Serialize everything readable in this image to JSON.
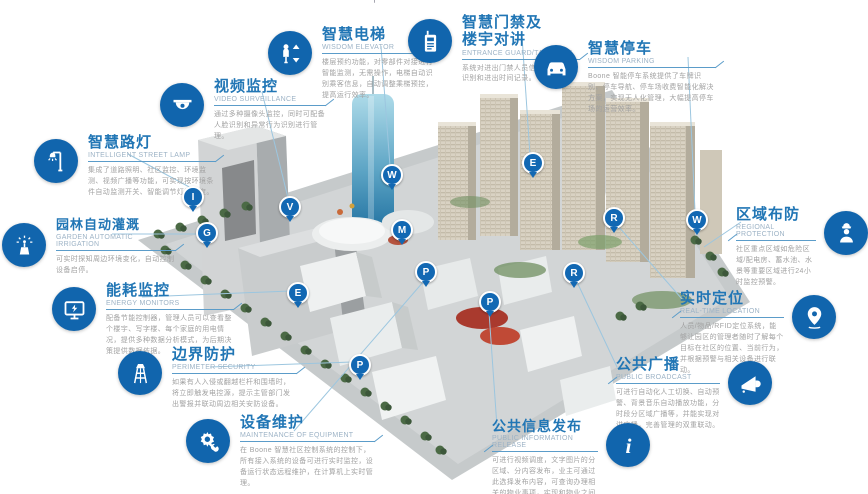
{
  "colors": {
    "icon_circle_blue": "#1165ad",
    "title_blue": "#2176b5",
    "subtitle_gray": "#9db3c6",
    "desc_gray": "#a2a2a2",
    "connector_blue": "#9cc6df",
    "marker_blue": "#1268b3",
    "red_accent_roof": "#a93a2e"
  },
  "top_edge_fragment": "丶丶丨丶丶丶",
  "callouts": [
    {
      "id": "wisdom-elevator",
      "title": "智慧电梯",
      "subtitle": "WISDOM ELEVATOR",
      "icon": "elevator-icon",
      "desc": "楼层预约功能，对零部件对接进行智能监测，无需操作，电梯自动识别乘客信息，自动调整乘梯预控，提高运行效率。"
    },
    {
      "id": "entrance-guard",
      "title": "智慧门禁及\n楼宇对讲",
      "subtitle": "ENTRANCE GUARD/TALKBACK",
      "icon": "intercom-icon",
      "desc": "系统对进出门禁人员信息进行自动识别和进出时间记录。"
    },
    {
      "id": "wisdom-parking",
      "title": "智慧停车",
      "subtitle": "WISDOM PARKING",
      "icon": "car-icon",
      "desc": "Boone 智能停车系统提供了车牌识别、停车导航、停车场收费智能化解决方案，实现无人化管理，大幅提高停车场的运营效率。"
    },
    {
      "id": "video-surveillance",
      "title": "视频监控",
      "subtitle": "VIDEO SURVEILLANCE",
      "icon": "dome-camera-icon",
      "desc": "通过多种摄像头监控，同时可配备人脸识别和异常行为识别进行管理。"
    },
    {
      "id": "street-lamp",
      "title": "智慧路灯",
      "subtitle": "INTELLIGENT STREET LAMP",
      "icon": "street-lamp-icon",
      "desc": "集成了道路照明、社区监控、环境监测、视频广播等功能，可实现按环境条件自动监测开关、智能调节灯光亮度。"
    },
    {
      "id": "garden-irrigation",
      "title": "园林自动灌溉",
      "subtitle": "GARDEN AUTOMATIC IRRIGATION",
      "icon": "sprinkler-icon",
      "desc": "可实时探知周边环境变化，自动控制设备启停。"
    },
    {
      "id": "energy-monitors",
      "title": "能耗监控",
      "subtitle": "ENERGY MONITORS",
      "icon": "energy-monitor-icon",
      "desc": "配备节能控制器，管理人员可以查看整个楼宇、写字楼、每个家庭的用电情况，提供多种数据分析模式，为后期决策提供数据依据。"
    },
    {
      "id": "perimeter-security",
      "title": "边界防护",
      "subtitle": "PERIMETER SECURITY",
      "icon": "watchtower-icon",
      "desc": "如果有人入侵或翻越栏杆和围墙时，将立即触发电控源，提示主管部门发出警报并联动周边相关安防设备。"
    },
    {
      "id": "equipment-maintenance",
      "title": "设备维护",
      "subtitle": "MAINTENANCE OF EQUIPMENT",
      "icon": "gear-wrench-icon",
      "desc": "在 Boone 智慧社区控制系统的控制下，所有接入系统的设备可进行实时监控，设备运行状态远程维护，在计算机上实时管理。"
    },
    {
      "id": "regional-protection",
      "title": "区域布防",
      "subtitle": "REGIONAL PROTECTION",
      "icon": "guard-icon",
      "desc": "社区重点区域如危险区域/配电房、蓄水池、水景等重要区域进行24小时监控预警。"
    },
    {
      "id": "real-time-location",
      "title": "实时定位",
      "subtitle": "REAL-TIME LOCATION",
      "icon": "location-pin-icon",
      "desc": "人员/物品/RFID定位系统，能够让园区的管理者随时了解每个目标在社区的位置、当前行为，并根据预警与相关设备进行联动。"
    },
    {
      "id": "public-broadcast",
      "title": "公共广播",
      "subtitle": "PUBLIC BROADCAST",
      "icon": "megaphone-icon",
      "desc": "可进行自动化人工切换、自动预警、背景音乐自动播放功能，分时段分区域广播等，并能实现对讲广播，完善管理的双重联动。"
    },
    {
      "id": "public-info-release",
      "title": "公共信息发布",
      "subtitle": "PUBLIC INFORMATION RELEASE",
      "icon": "info-icon",
      "desc": "可进行视频调度，文字图片的分区域、分内容发布，业主可通过此选择发布内容，可查询办理相关的物业事项，实现和物业之间沟通。"
    }
  ],
  "markers": [
    {
      "letter": "I"
    },
    {
      "letter": "G"
    },
    {
      "letter": "V"
    },
    {
      "letter": "W"
    },
    {
      "letter": "M"
    },
    {
      "letter": "E"
    },
    {
      "letter": "P"
    },
    {
      "letter": "E"
    },
    {
      "letter": "R"
    },
    {
      "letter": "W"
    },
    {
      "letter": "R"
    },
    {
      "letter": "P"
    },
    {
      "letter": "P"
    }
  ]
}
